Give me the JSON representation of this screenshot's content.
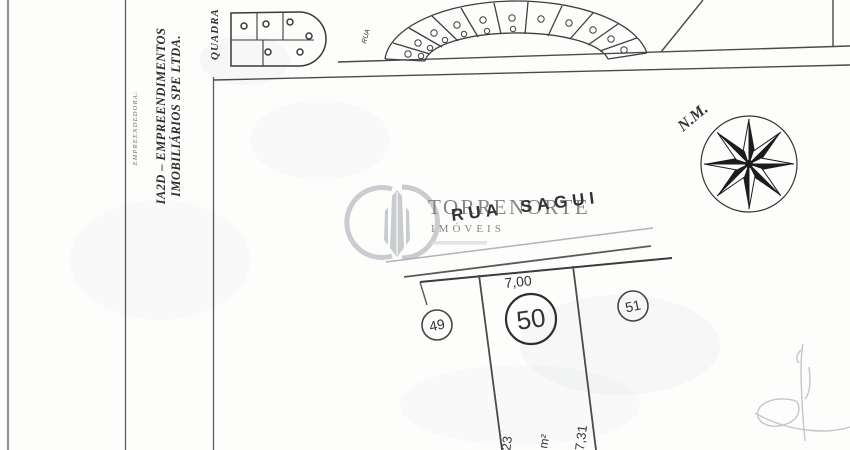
{
  "title_block": {
    "role_label": "EMPREENDEDORA:",
    "company_line1": "IA2D – EMPREENDIMENTOS",
    "company_line2": "IMOBILIÁRIOS SPE LTDA."
  },
  "map": {
    "quadra_label": "QUADRA",
    "minor_street_label": "RUA",
    "street_name": "RUA SAGUI",
    "north_marker": "N.M.",
    "lot_left": "49",
    "lot_center": "50",
    "lot_right": "51",
    "dim_front": "7,00",
    "dim_left_side": "25,23",
    "dim_right_side": "27,31",
    "area_unit": "m²"
  },
  "watermark": {
    "brand": "TORRENORTE",
    "brand_category": "IMÓVEIS"
  },
  "colors": {
    "ink": "#3a3a3a",
    "light_line": "#b0b4b8",
    "watermark_gray": "#9aa0a6",
    "paper": "#fdfdfc"
  }
}
